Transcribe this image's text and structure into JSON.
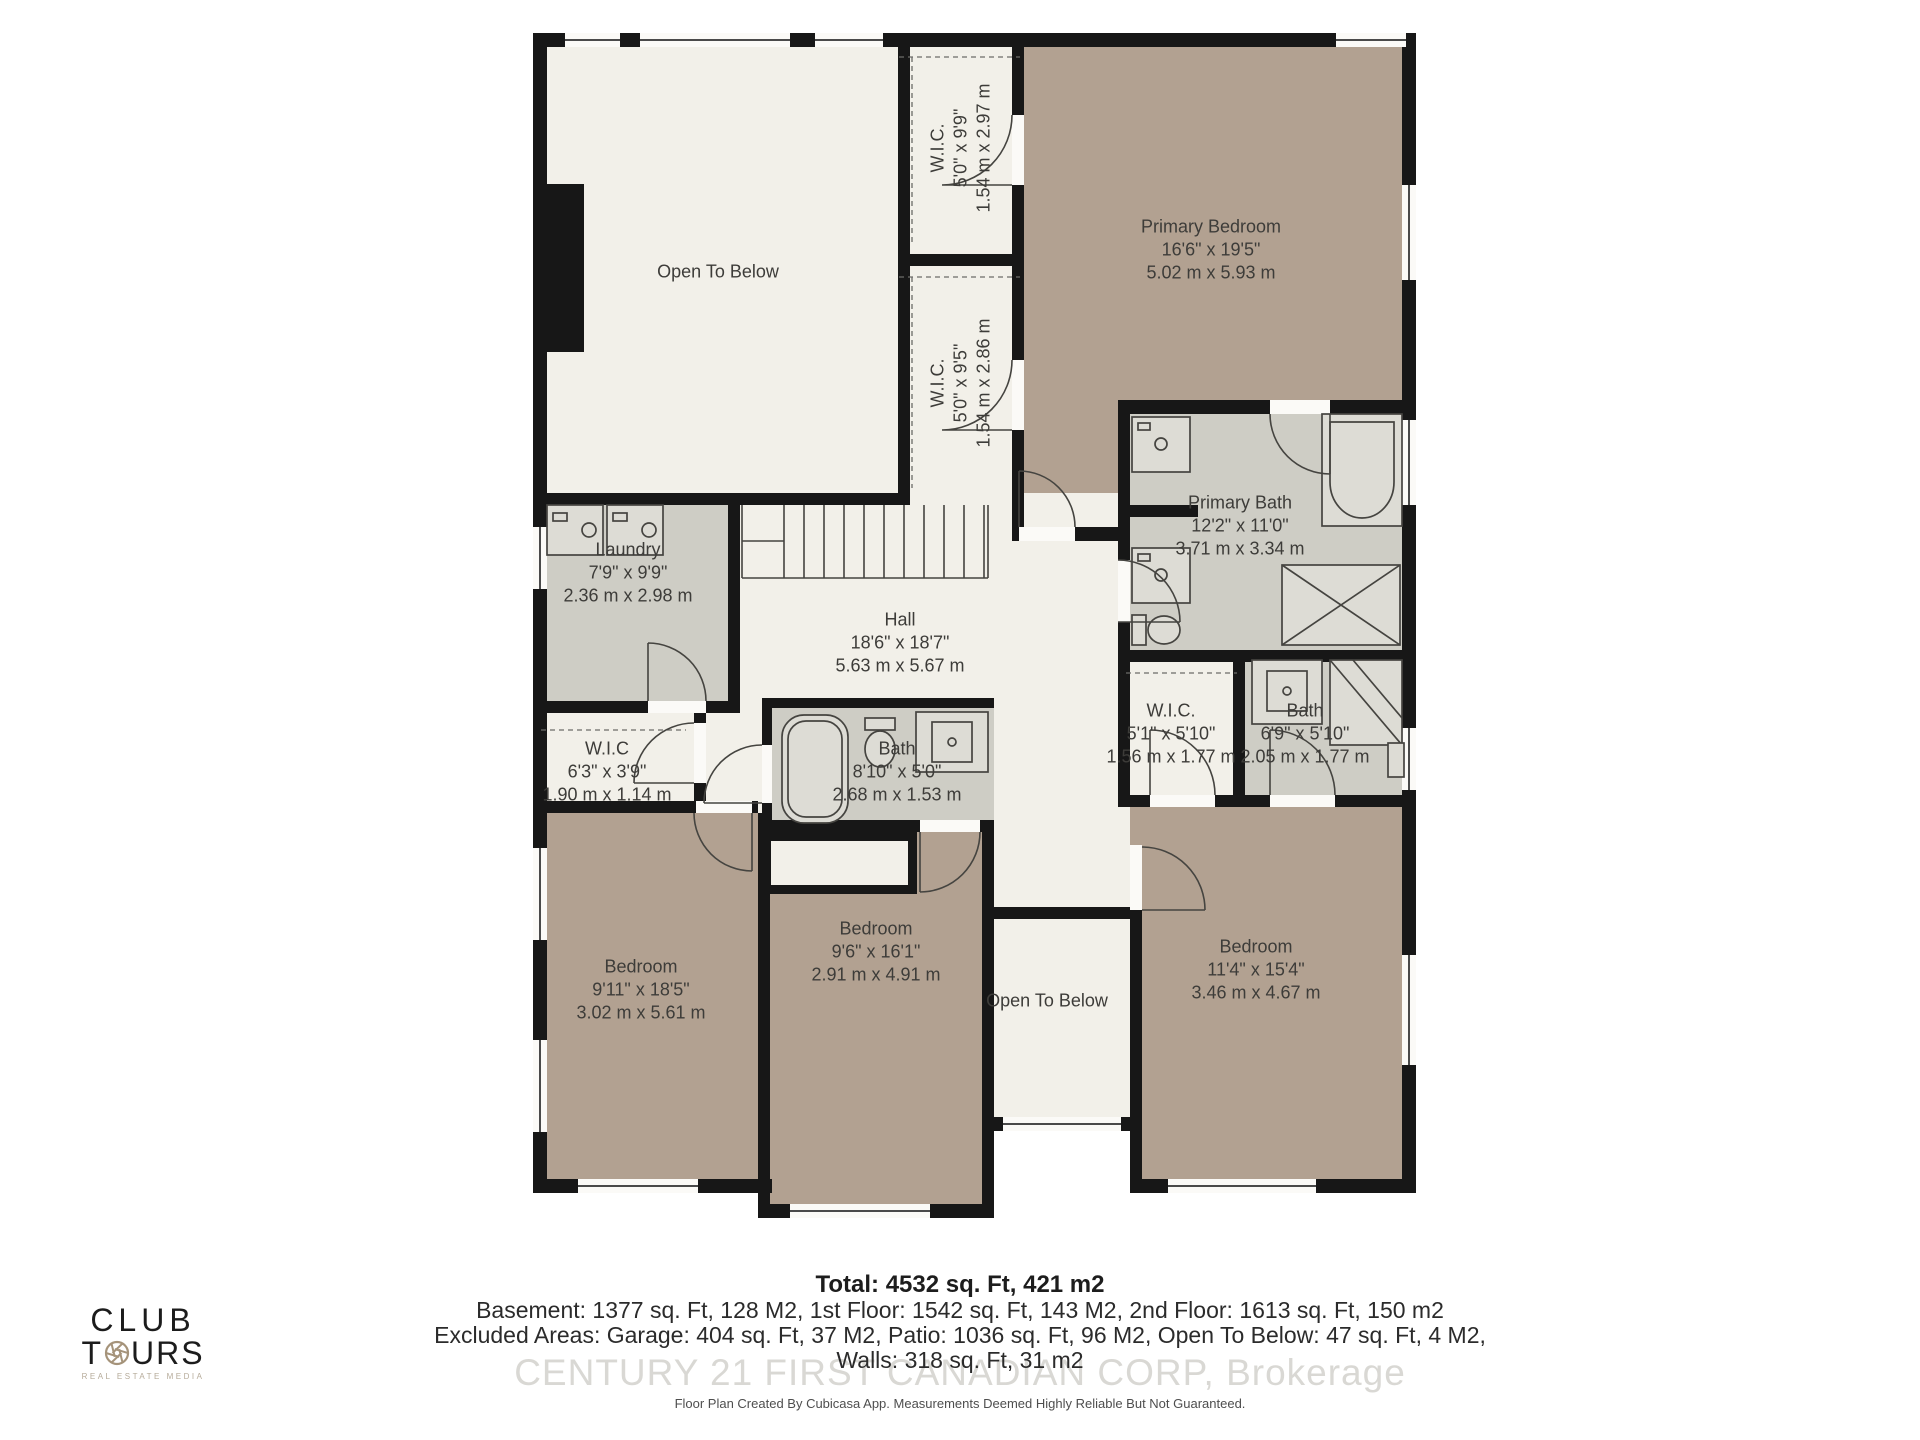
{
  "title": "Second Floor Plan",
  "colors": {
    "bedroom_fill": "#b2a191",
    "bath_fill": "#cecdc5",
    "floor_fill": "#f2f0e9",
    "wall": "#171717",
    "logo_accent": "#a5937a",
    "watermark_color": "#d9d8d4"
  },
  "rooms": {
    "open_to_below_top": {
      "name": "Open To Below"
    },
    "wic_top1": {
      "name": "W.I.C.",
      "imperial": "5'0\" x 9'9\"",
      "metric": "1.54 m x 2.97 m"
    },
    "wic_top2": {
      "name": "W.I.C.",
      "imperial": "5'0\" x 9'5\"",
      "metric": "1.54 m x 2.86 m"
    },
    "primary_bedroom": {
      "name": "Primary Bedroom",
      "imperial": "16'6\" x 19'5\"",
      "metric": "5.02 m x 5.93 m"
    },
    "primary_bath": {
      "name": "Primary Bath",
      "imperial": "12'2\" x 11'0\"",
      "metric": "3.71 m x 3.34 m"
    },
    "laundry": {
      "name": "Laundry",
      "imperial": "7'9\" x 9'9\"",
      "metric": "2.36 m x 2.98 m"
    },
    "hall": {
      "name": "Hall",
      "imperial": "18'6\" x 18'7\"",
      "metric": "5.63 m x 5.67 m"
    },
    "wic_left": {
      "name": "W.I.C",
      "imperial": "6'3\" x 3'9\"",
      "metric": "1.90 m x 1.14 m"
    },
    "bath_center": {
      "name": "Bath",
      "imperial": "8'10\" x 5'0\"",
      "metric": "2.68 m x 1.53 m"
    },
    "wic_right": {
      "name": "W.I.C.",
      "imperial": "5'1\" x 5'10\"",
      "metric": "1.56 m x 1.77 m"
    },
    "bath_right": {
      "name": "Bath",
      "imperial": "6'9\" x 5'10\"",
      "metric": "2.05 m x 1.77 m"
    },
    "bedroom_left": {
      "name": "Bedroom",
      "imperial": "9'11\" x 18'5\"",
      "metric": "3.02 m x 5.61 m"
    },
    "bedroom_center": {
      "name": "Bedroom",
      "imperial": "9'6\" x 16'1\"",
      "metric": "2.91 m x 4.91 m"
    },
    "open_to_below_bottom": {
      "name": "Open To Below"
    },
    "bedroom_right": {
      "name": "Bedroom",
      "imperial": "11'4\" x 15'4\"",
      "metric": "3.46 m x 4.67 m"
    }
  },
  "footer": {
    "total": "Total: 4532 sq. Ft, 421 m2",
    "line2": "Basement: 1377 sq. Ft, 128 M2, 1st Floor: 1542 sq. Ft, 143 M2, 2nd Floor: 1613 sq. Ft, 150 m2",
    "line3": "Excluded Areas: Garage: 404 sq. Ft, 37 M2, Patio: 1036 sq. Ft, 96 M2, Open To Below: 47 sq. Ft, 4 M2,",
    "line4": "Walls: 318 sq. Ft, 31 m2",
    "watermark": "CENTURY 21 FIRST CANADIAN CORP, Brokerage",
    "fineprint": "Floor Plan Created By Cubicasa App. Measurements Deemed Highly Reliable But Not Guaranteed."
  },
  "logo": {
    "line1": "CLUB",
    "line2_pre": "T",
    "line2_post": "URS",
    "tagline": "REAL ESTATE MEDIA",
    "aperture_icon": "camera-aperture"
  }
}
